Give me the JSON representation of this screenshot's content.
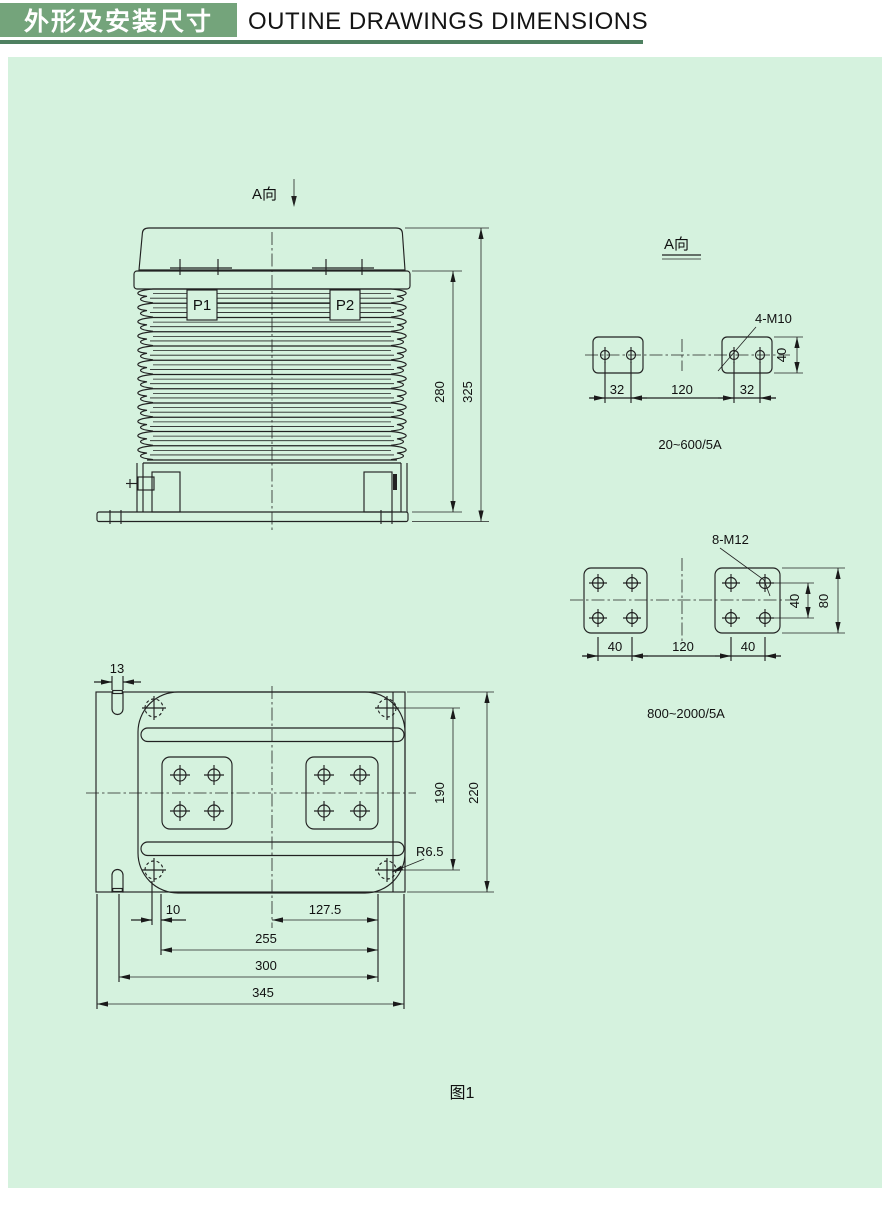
{
  "header": {
    "title_cn": "外形及安装尺寸",
    "title_en": "OUTINE DRAWINGS DIMENSIONS"
  },
  "colors": {
    "title_bar_green": "#74a47b",
    "underline_green": "#4e8060",
    "panel_green": "#d5f2de",
    "line_color": "#222222"
  },
  "front_view": {
    "view_label": "A向",
    "p1": "P1",
    "p2": "P2",
    "dim_body_height": "280",
    "dim_total_height": "325"
  },
  "a_view": {
    "view_label": "A向",
    "callout": "4-M10",
    "dim_left": "32",
    "dim_center": "120",
    "dim_right": "32",
    "dim_height": "40",
    "range_label": "20~600/5A"
  },
  "pad_view": {
    "callout": "8-M12",
    "dim_left": "40",
    "dim_center": "120",
    "dim_right": "40",
    "dim_inner": "40",
    "dim_outer": "80",
    "range_label": "800~2000/5A"
  },
  "bottom_view": {
    "dim_slot": "13",
    "dim_offset": "10",
    "dim_half": "127.5",
    "dim_pads": "255",
    "dim_mount": "300",
    "dim_total": "345",
    "dim_inner": "190",
    "dim_outer": "220",
    "radius_callout": "R6.5"
  },
  "caption": {
    "figure": "图1"
  }
}
